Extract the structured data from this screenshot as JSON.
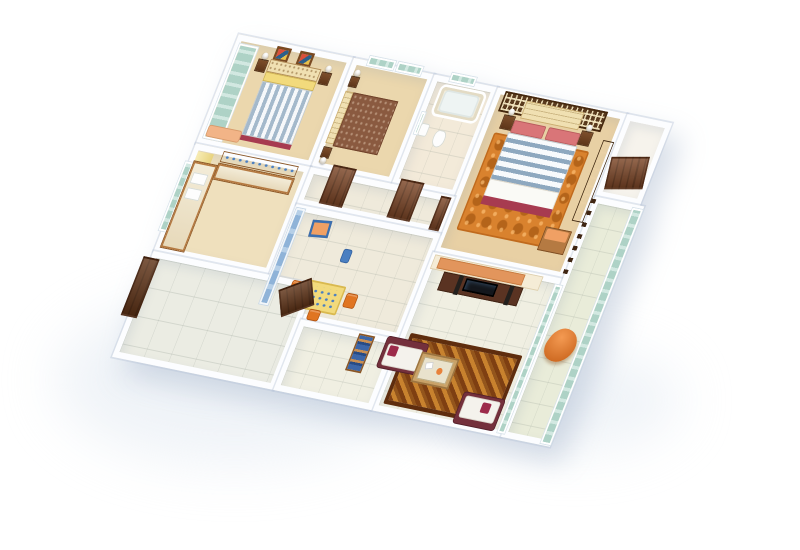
{
  "scene": {
    "description": "3D isometric cutaway render of a 3BHK apartment floor plan on a white background, viewed from above at an angle; no visible text in the image",
    "background": "#ffffff",
    "shadow_color": "#e3eaf2"
  },
  "palette": {
    "wall": "#fcfdff",
    "wood_floor": "#ebd7ad",
    "wood_floor_master": "#e8d0a4",
    "kitchen_floor": "#efe0bd",
    "tile_cream": "#efeadb",
    "tile_bath": "#f3ead9",
    "tile_store": "#ebece3",
    "tile_living": "#f0efe2",
    "tile_balcony": "#e9ecd9",
    "foyer_floor": "#f6f3ec",
    "door_wood": "#7b4526",
    "door_dark": "#5f3317",
    "glass_teal": "#aed2c6",
    "glass_blue": "#8fb3d8",
    "curtain_yellow": "#f4e6a2",
    "rug_master": "#d9822e",
    "rug_living": "#c8822e",
    "sofa_frame": "#74303c",
    "sofa_cushion": "#f4f2ec",
    "pillow_maroon": "#9c2a4a",
    "armchair_orange": "#e8813a",
    "dining_chair_orange": "#e07522",
    "table_yellow": "#f2da7c",
    "counter_wood": "#b57a42",
    "shelf_wood": "#c08448",
    "lattice_brown": "#5a3a1e",
    "headboard_cream": "#f0e0b2",
    "pillow_pink": "#d97578",
    "throw_maroon": "#a73b50",
    "duvet_stripe_blue": "#8ea8bf",
    "bedroom3_cover": "#8a5a40",
    "books_blue": "#3c66a8",
    "bin_blue": "#4a7fc1",
    "chest_top_peach": "#f0a064",
    "bench_peach": "#f2b487",
    "halfwall_orange": "#e2955c",
    "tv_black": "#14171c",
    "console_wood": "#5a3322"
  },
  "rooms": [
    {
      "id": "bedroom-small",
      "label": "Bedroom 2",
      "floor": "#ebd7ad",
      "furniture": [
        "teal-glass-sliding-wardrobe",
        "double-bed-blue-striped-duvet",
        "yellow-pillow-band",
        "two-wall-pictures",
        "two-nightstands-with-lamps",
        "peach-bench"
      ]
    },
    {
      "id": "bedroom-guest",
      "label": "Bedroom 3",
      "floor": "#ebd7ad",
      "furniture": [
        "bed-brown-patterned-cover",
        "cream-headboard",
        "two-nightstands-with-lamps",
        "two-teal-windows"
      ]
    },
    {
      "id": "bathroom",
      "label": "Bathroom",
      "floor": "#f3ead9",
      "furniture": [
        "bathtub",
        "toilet",
        "wash-basin",
        "mirror",
        "teal-window"
      ]
    },
    {
      "id": "master-bedroom",
      "label": "Master Bedroom",
      "floor": "#e8d0a4",
      "furniture": [
        "dark-lattice-headboard-wall",
        "cream-tufted-headboard",
        "double-bed-striped-duvet",
        "pink-pillows",
        "maroon-foot-throw",
        "orange-swirl-rug",
        "two-nightstands-with-lamps",
        "chest-of-drawers-peach-top",
        "dark-wardrobe"
      ]
    },
    {
      "id": "foyer",
      "label": "Entrance Foyer",
      "floor": "#f6f3ec",
      "furniture": [
        "entrance-door",
        "stair-railing"
      ]
    },
    {
      "id": "kitchen",
      "label": "Kitchen",
      "floor": "#efe0bd",
      "furniture": [
        "counter-with-double-sink",
        "wall-counter",
        "wall-shelves-with-blue-crockery",
        "window-with-yellow-curtain"
      ]
    },
    {
      "id": "corridor",
      "label": "Corridor",
      "floor": "#efeadb",
      "furniture": [
        "door-to-bedroom",
        "door-to-bathroom",
        "door-to-master"
      ]
    },
    {
      "id": "dining",
      "label": "Dining Room",
      "floor": "#efeadb",
      "furniture": [
        "blue-glass-partition",
        "yellow-dining-table",
        "three-orange-chairs",
        "blue-framed-picture",
        "blue-waste-bin"
      ]
    },
    {
      "id": "store",
      "label": "Utility Room",
      "floor": "#ebece3",
      "furniture": [
        "large-brown-door",
        "open-door-panel"
      ]
    },
    {
      "id": "living",
      "label": "Living Room",
      "floor": "#f0efe2",
      "furniture": [
        "patterned-brown-rug",
        "two-maroon-white-sofas",
        "coffee-table",
        "tv-console-with-tv-and-speakers",
        "half-wall-orange-panel",
        "bookshelf-with-blue-books"
      ]
    },
    {
      "id": "balcony",
      "label": "Balcony",
      "floor": "#e9ecd9",
      "furniture": [
        "teal-glass-enclosure",
        "orange-lounge-chair"
      ]
    }
  ]
}
